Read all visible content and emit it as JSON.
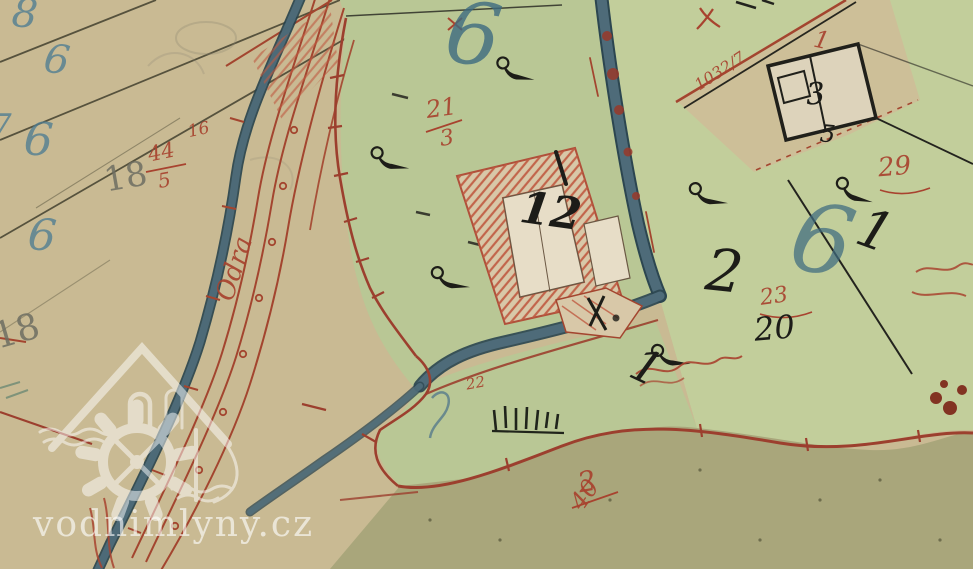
{
  "map_title": "historic cadastral map sheet (water mill site)",
  "watermark": {
    "text": "vodnimlyny.cz",
    "logo": "watermill-house-logo"
  },
  "labels": [
    {
      "text": "8",
      "ink": "blue"
    },
    {
      "text": "6",
      "ink": "blue"
    },
    {
      "text": "7",
      "ink": "blue"
    },
    {
      "text": "6",
      "ink": "blue"
    },
    {
      "text": "6",
      "ink": "blue"
    },
    {
      "text": "18",
      "ink": "pencil"
    },
    {
      "text": "18",
      "ink": "pencil"
    },
    {
      "text": "44",
      "ink": "red"
    },
    {
      "text": "5",
      "ink": "red"
    },
    {
      "text": "16",
      "ink": "red"
    },
    {
      "text": "Odra",
      "ink": "red"
    },
    {
      "text": "21",
      "ink": "red"
    },
    {
      "text": "3",
      "ink": "red"
    },
    {
      "text": "6",
      "ink": "blue"
    },
    {
      "text": "12",
      "ink": "black"
    },
    {
      "text": "22",
      "ink": "red"
    },
    {
      "text": "2",
      "ink": "black"
    },
    {
      "text": "6",
      "ink": "blue"
    },
    {
      "text": "23",
      "ink": "red"
    },
    {
      "text": "20",
      "ink": "black"
    },
    {
      "text": "1",
      "ink": "black"
    },
    {
      "text": "1",
      "ink": "black"
    },
    {
      "text": "29",
      "ink": "red"
    },
    {
      "text": "1",
      "ink": "red"
    },
    {
      "text": "3",
      "ink": "black"
    },
    {
      "text": "5",
      "ink": "black"
    },
    {
      "text": "1032/7",
      "ink": "red"
    },
    {
      "text": "2",
      "ink": "red"
    },
    {
      "text": "40",
      "ink": "red"
    }
  ],
  "colors": {
    "parchment": "#c9ba93",
    "meadow_green": "#b9c795",
    "hatched_garden_green": "#c2ce9b",
    "field_olive": "#a9a67b",
    "stream_blue": "#4e6b79",
    "boundary_red": "#9c3f2e",
    "annotation_red": "#a8432f",
    "ink_black": "#1d1d18",
    "ink_blue": "#4f7d92",
    "pencil_gray": "#6e6e62",
    "watermark_white": "rgba(255,255,255,0.55)"
  }
}
